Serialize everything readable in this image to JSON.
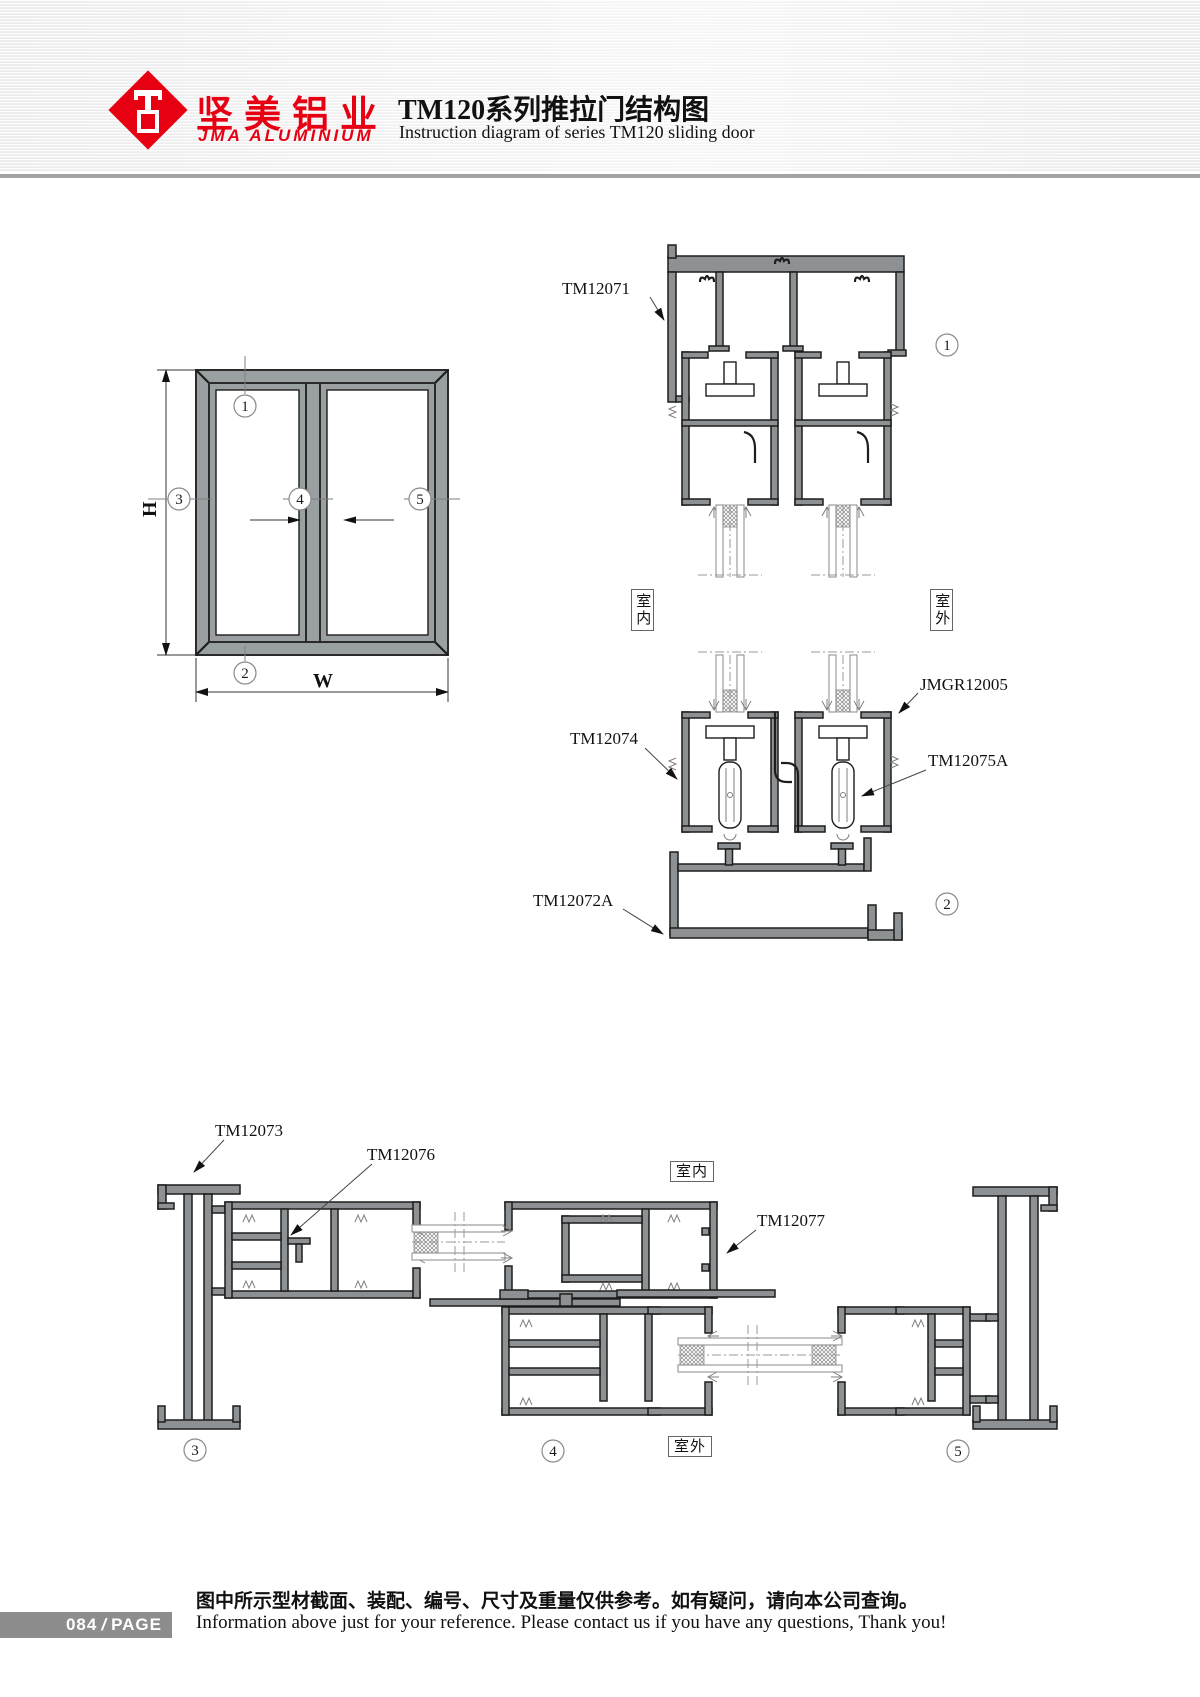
{
  "header": {
    "logo_cn": "坚美铝业",
    "logo_en": "JMA ALUMINIUM",
    "title_cn": "TM120系列推拉门结构图",
    "title_en": "Instruction diagram of series TM120 sliding door"
  },
  "elevation": {
    "height_label": "H",
    "width_label": "W",
    "callout_1": "1",
    "callout_2": "2",
    "callout_3": "3",
    "callout_4": "4",
    "callout_5": "5"
  },
  "section_vertical": {
    "part_head": "TM12071",
    "part_glazing_bead": "JMGR12005",
    "part_sash_bottom": "TM12074",
    "part_bead_a": "TM12075A",
    "part_sill": "TM12072A",
    "detail_1": "1",
    "detail_2": "2",
    "indoor": "室内",
    "outdoor": "室外"
  },
  "section_horizontal": {
    "part_jamb": "TM12073",
    "part_interlock": "TM12076",
    "part_stile": "TM12077",
    "detail_3": "3",
    "detail_4": "4",
    "detail_5": "5",
    "indoor": "室内",
    "outdoor": "室外"
  },
  "footer": {
    "page_number": "084",
    "page_label": "PAGE",
    "note_cn": "图中所示型材截面、装配、编号、尺寸及重量仅供参考。如有疑问，请向本公司查询。",
    "note_en": "Information above just for your reference. Please contact us if you have any questions, Thank you!"
  },
  "colors": {
    "brand_red": "#e60012",
    "line_dark": "#1d1d1d",
    "aluminum_gray": "#8d9194",
    "badge_gray": "#8d8d8d"
  }
}
